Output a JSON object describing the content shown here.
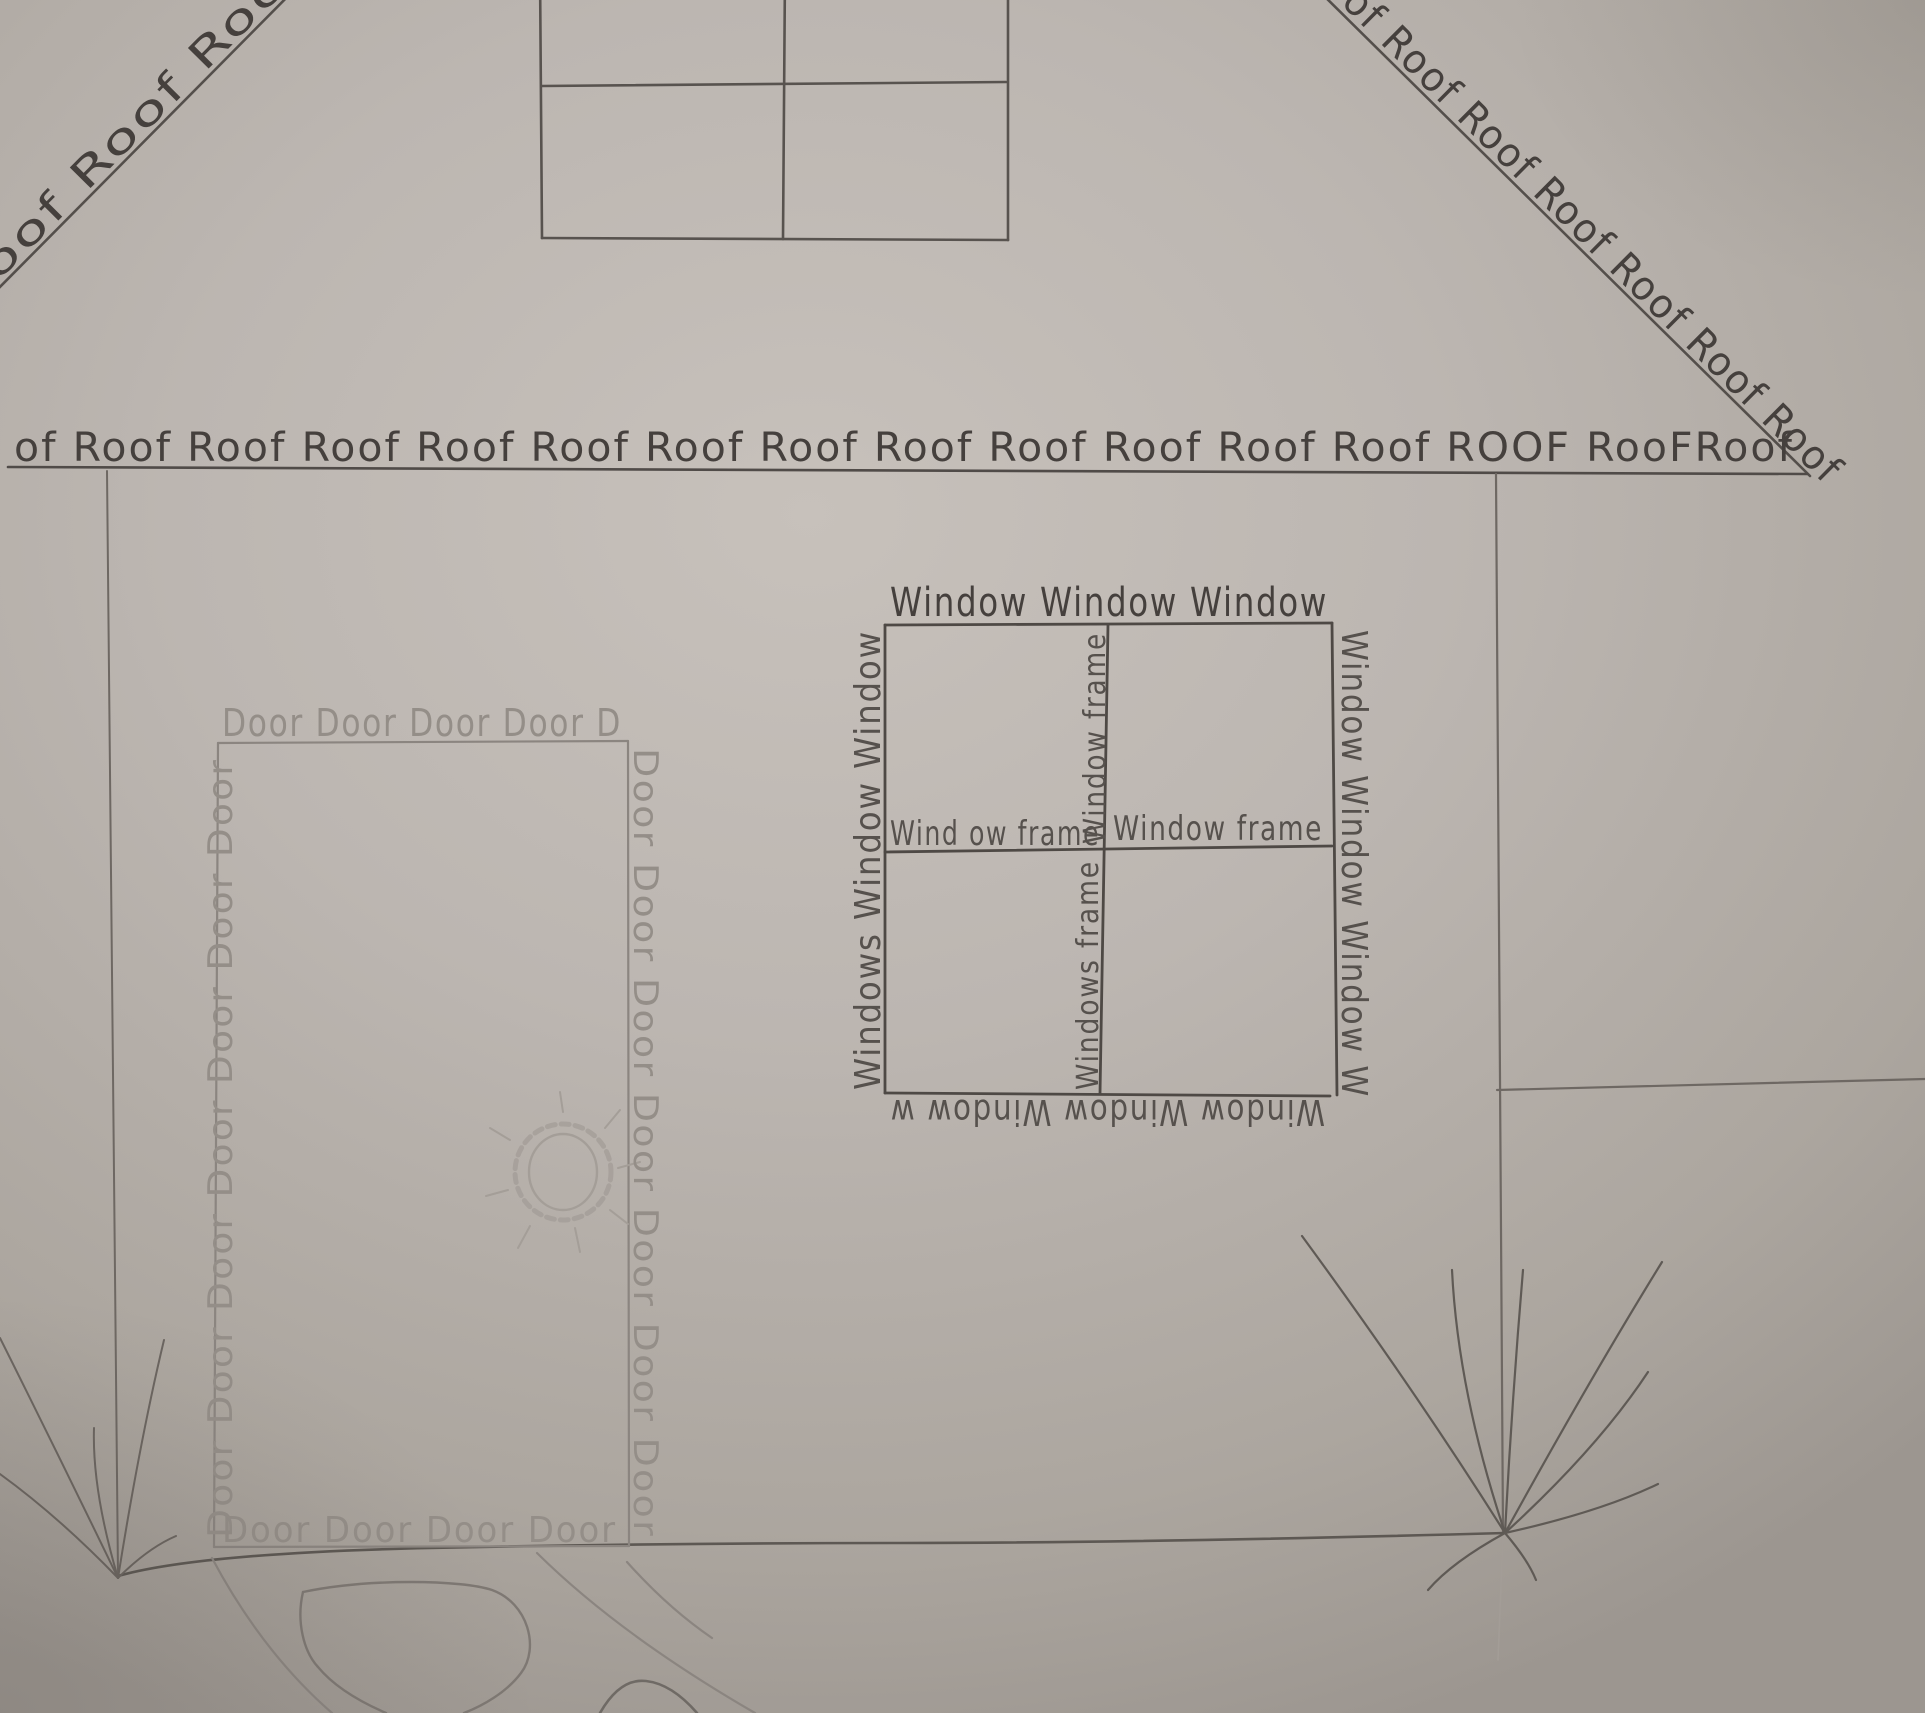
{
  "roof": {
    "left_diagonal_text": "oof Roof Roof",
    "right_diagonal_text": "oof Roof Roof Roof Roof Roof Roof",
    "eave_text": "of Roof Roof Roof Roof Roof Roof Roof Roof Roof Roof Roof Roof ROOF RooFRoof"
  },
  "door": {
    "top_text": "Door Door Door Door D",
    "left_text": "Door Door Door Door Door Door Door",
    "right_text": "Door Door Door Door Door Door Door",
    "bottom_text": "Door Door Door Door"
  },
  "window": {
    "top_text": "Window Window Window",
    "left_text": "Windows Window Window",
    "right_text": "Window Window Window W",
    "bottom_text": "Window Window Window w",
    "frame_h_left_text": "Wind ow frame",
    "frame_h_right_text": "Window frame",
    "frame_v_top_text": "Window frame",
    "frame_v_bottom_text": "Windows frame"
  },
  "colors": {
    "paper": "#bcb6b1",
    "pencil_dark": "#45403d",
    "pencil_mid": "#56514d",
    "pencil_soft": "#6e6863",
    "pencil_faint": "#948e88"
  }
}
